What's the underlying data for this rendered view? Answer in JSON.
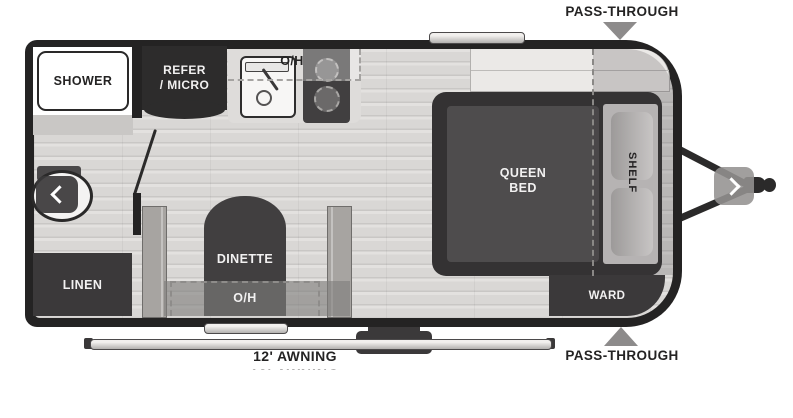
{
  "fp": {
    "pass_top": "PASS-THROUGH",
    "pass_bottom": "PASS-THROUGH",
    "awning": "12' AWNING",
    "shower": "SHOWER",
    "refer1": "REFER",
    "refer2": "/ MICRO",
    "oh_kitchen": "O/H",
    "queen1": "QUEEN",
    "queen2": "BED",
    "shelf": "SHELF",
    "ward": "WARD",
    "linen": "LINEN",
    "dinette": "DINETTE",
    "oh_dinette": "O/H"
  },
  "icons": {
    "prev": "chevron-left",
    "next": "chevron-right",
    "pass_marker_top": "triangle-down",
    "pass_marker_bottom": "triangle-up"
  },
  "colors": {
    "wall": "#242323",
    "furniture_dark": "#3b393a",
    "bench_gray": "#a7a4a1",
    "floor": "#d9d7d5",
    "marker_gray": "#8d8b8b",
    "label_text": "#242323",
    "label_text_light": "#f2f1f1",
    "background": "#ffffff"
  }
}
